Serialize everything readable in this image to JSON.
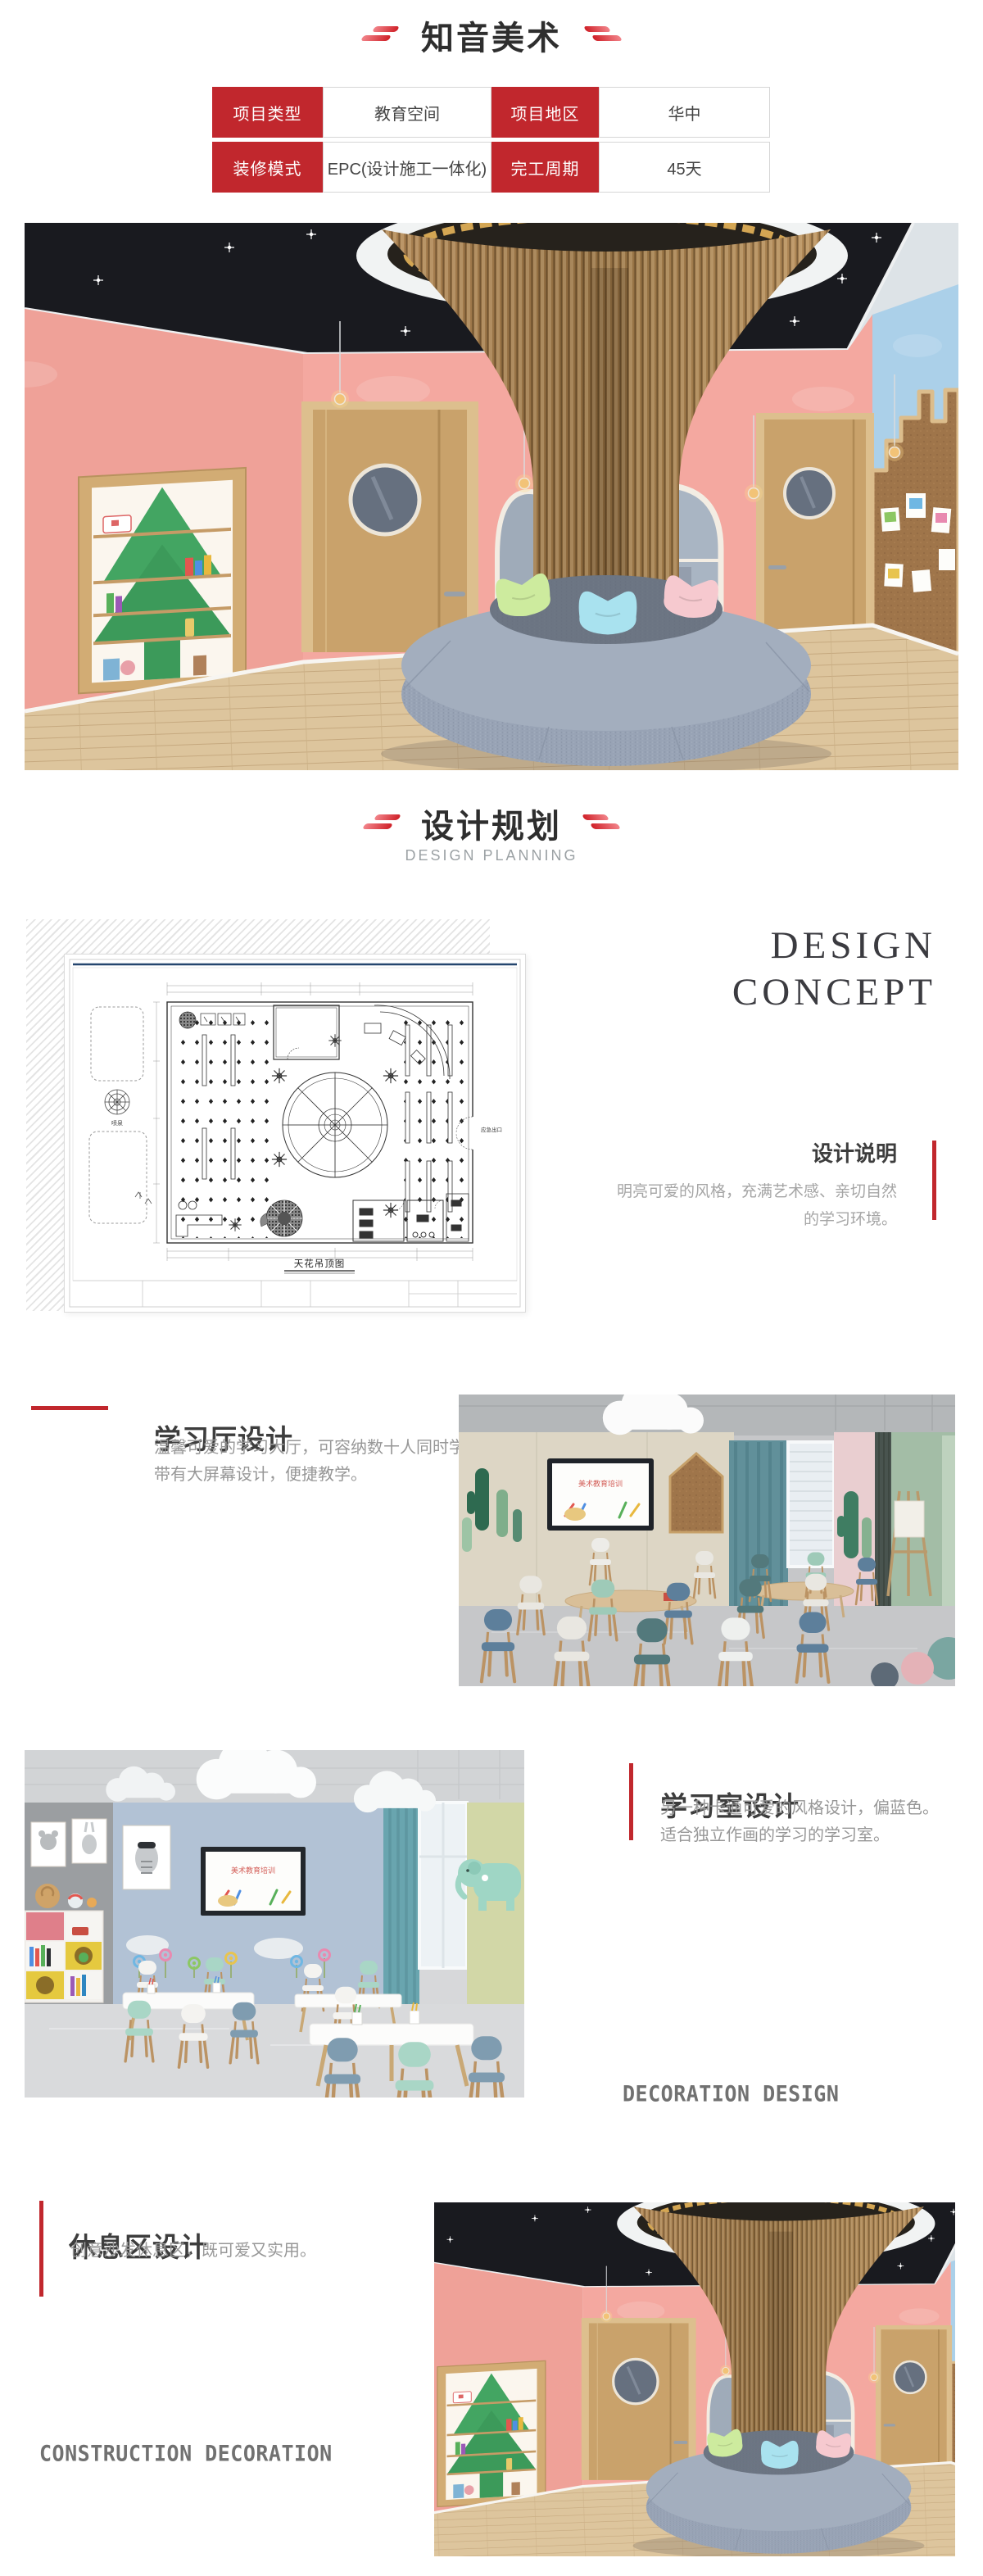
{
  "header": {
    "title": "知音美术"
  },
  "info_table": {
    "rows": [
      {
        "label1": "项目类型",
        "value1": "教育空间",
        "label2": "项目地区",
        "value2": "华中"
      },
      {
        "label1": "装修模式",
        "value1": "EPC(设计施工一体化)",
        "label2": "完工周期",
        "value2": "45天"
      }
    ]
  },
  "planning_header": {
    "title": "设计规划",
    "subtitle": "DESIGN PLANNING"
  },
  "design_concept": {
    "heading_line1": "DESIGN",
    "heading_line2": "CONCEPT",
    "section_title": "设计说明",
    "desc_line1": "明亮可爱的风格，充满艺术感、亲切自然",
    "desc_line2": "的学习环境。"
  },
  "floor_plan": {
    "caption": "天花吊顶图",
    "fountain_label": "喷泉",
    "exit_label": "应急出口"
  },
  "hall_section": {
    "title": "学习厅设计",
    "desc_line1": "温馨可爱的学习大厅，可容纳数十人同时学习，",
    "desc_line2": "带有大屏幕设计，便捷教学。",
    "screen_text": "美术教育培训"
  },
  "room_section": {
    "title": "学习室设计",
    "desc_line1": "另一种卡通可爱的风格设计，偏蓝色。",
    "desc_line2": "适合独立作画的学习的学习室。",
    "watermark": "DECORATION DESIGN",
    "screen_text": "美术教育培训"
  },
  "rest_section": {
    "title": "休息区设计",
    "desc": "创意沙发休息区，既可爱又实用。",
    "watermark": "CONSTRUCTION DECORATION"
  },
  "colors": {
    "accent_red": "#c1272d",
    "pink_wall": "#f4a8a0",
    "blue_wall": "#abd0e9",
    "shelf_green": "#3ea15f",
    "sofa_gray": "#98a3b5",
    "door_wood": "#c9a26b"
  }
}
